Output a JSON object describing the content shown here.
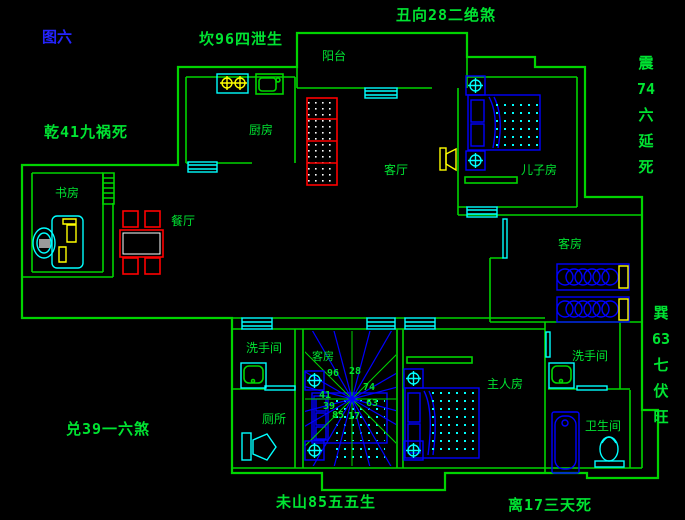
{
  "figure": {
    "label": "图六"
  },
  "fengshui_labels": {
    "top_left": "坎96四泄生",
    "top_center": "丑向28二绝煞",
    "left_upper": "乾41九祸死",
    "left_lower": "兑39一六煞",
    "right_upper": "震\n74\n六\n延\n死",
    "right_lower": "巽\n63\n七\n伏\n旺",
    "bottom_center": "未山85五五生",
    "bottom_right": "离17三天死"
  },
  "rooms": {
    "balcony": "阳台",
    "kitchen": "厨房",
    "living": "客厅",
    "son_room": "儿子房",
    "study": "书房",
    "dining": "餐厅",
    "guest_right": "客房",
    "washroom_left": "洗手间",
    "toilet": "厕所",
    "guest_center": "客房",
    "master": "主人房",
    "washroom_right": "洗手间",
    "bathroom": "卫生间"
  },
  "compass": {
    "numbers": {
      "n96": "96",
      "n28": "28",
      "n74": "74",
      "n63": "63",
      "n41": "41",
      "n39": "39",
      "n85": "85",
      "n17": "17"
    }
  },
  "colors": {
    "background": "#000000",
    "wall": "#00d400",
    "text": "#00e432",
    "figure": "#2424ff",
    "cyan": "#00ffff",
    "blue": "#0000ff",
    "yellow": "#ffff00",
    "red": "#ff0000",
    "magenta": "#ff0092",
    "white": "#ffffff",
    "gray": "#9a9a9a"
  }
}
